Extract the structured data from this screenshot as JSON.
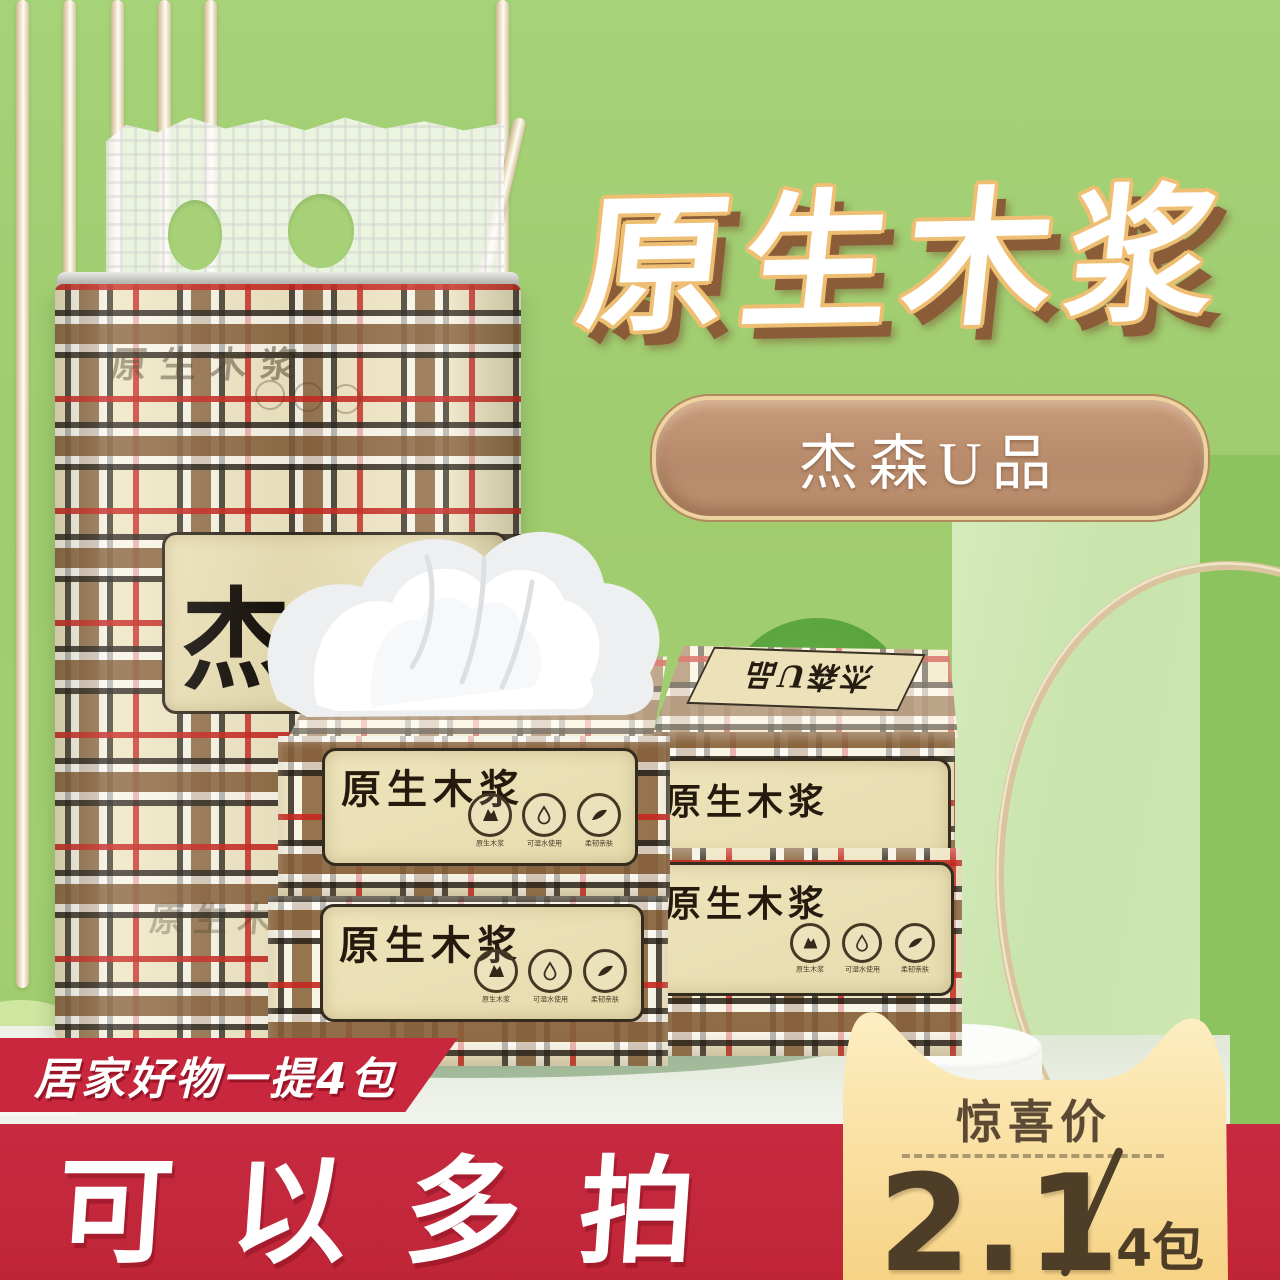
{
  "colors": {
    "background_green": "#a1ce71",
    "panel_green": "#cfe7b4",
    "accent_red": "#c5293c",
    "card_gold_top": "#fdeec2",
    "card_gold_bottom": "#f6d385",
    "badge_brown": "#bd9175",
    "title_outline": "#eebf72",
    "title_shadow": "#8a5c38",
    "price_text": "#4e3e28",
    "plaid_cream": "#efe6c4"
  },
  "hero": {
    "title": "原生木浆",
    "badge": "杰森U品"
  },
  "pack": {
    "watermark_top": "原生木浆",
    "brand_label": "杰森",
    "watermark_bottom": "原生木浆"
  },
  "boxes": {
    "label_title": "原生木浆",
    "top_strip_label": "杰森U品",
    "icons": [
      {
        "name": "wood-pulp-icon",
        "caption": "原生木浆"
      },
      {
        "name": "water-drop-icon",
        "caption": "可湿水使用"
      },
      {
        "name": "soft-touch-icon",
        "caption": "柔韧亲肤"
      }
    ]
  },
  "promo": {
    "ribbon": "居家好物一提4包",
    "headline": "可以多拍"
  },
  "price_card": {
    "label": "惊喜价",
    "price": "2.1",
    "separator": "/",
    "unit": "4包"
  }
}
